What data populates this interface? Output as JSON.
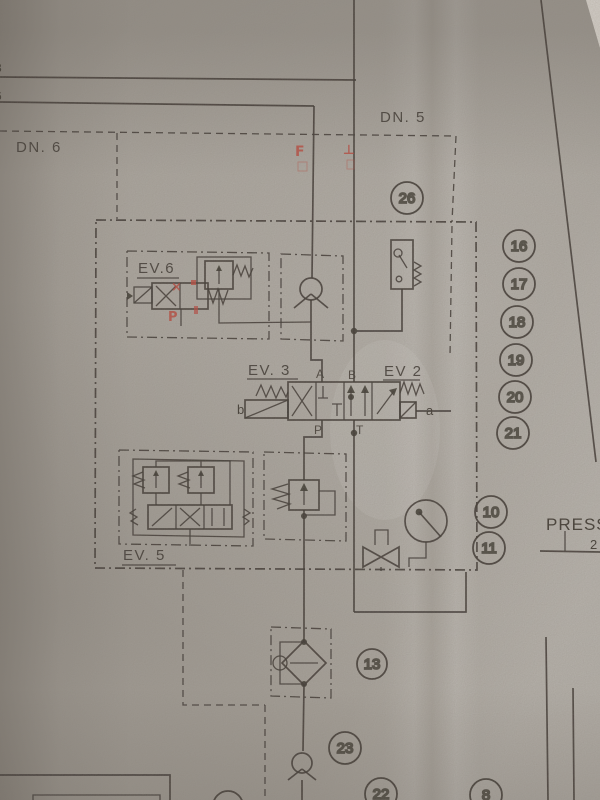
{
  "colors": {
    "paper": "#aba69f",
    "ink": "#38332d",
    "red": "#c0453a"
  },
  "labels": {
    "dn_left": "DN. 6",
    "dn_right": "DN. 5",
    "ev6": "EV.6",
    "ev3": "EV. 3",
    "ev2": "EV 2",
    "ev5": "EV. 5",
    "press": "PRESS",
    "press_next_partial": "2",
    "edge_top": "8",
    "edge_bottom": "6"
  },
  "ports": {
    "A": "A",
    "B": "B",
    "P": "P",
    "T": "T",
    "a": "a",
    "b": "b"
  },
  "balloons": [
    {
      "n": "26"
    },
    {
      "n": "16"
    },
    {
      "n": "17"
    },
    {
      "n": "18"
    },
    {
      "n": "19"
    },
    {
      "n": "20"
    },
    {
      "n": "21"
    },
    {
      "n": "10"
    },
    {
      "n": "11"
    },
    {
      "n": "13"
    },
    {
      "n": "23"
    },
    {
      "n": "22"
    },
    {
      "n": "8"
    }
  ],
  "red_annotations": {
    "f": "F",
    "tee": "⊥",
    "x": "×",
    "p": "P"
  }
}
